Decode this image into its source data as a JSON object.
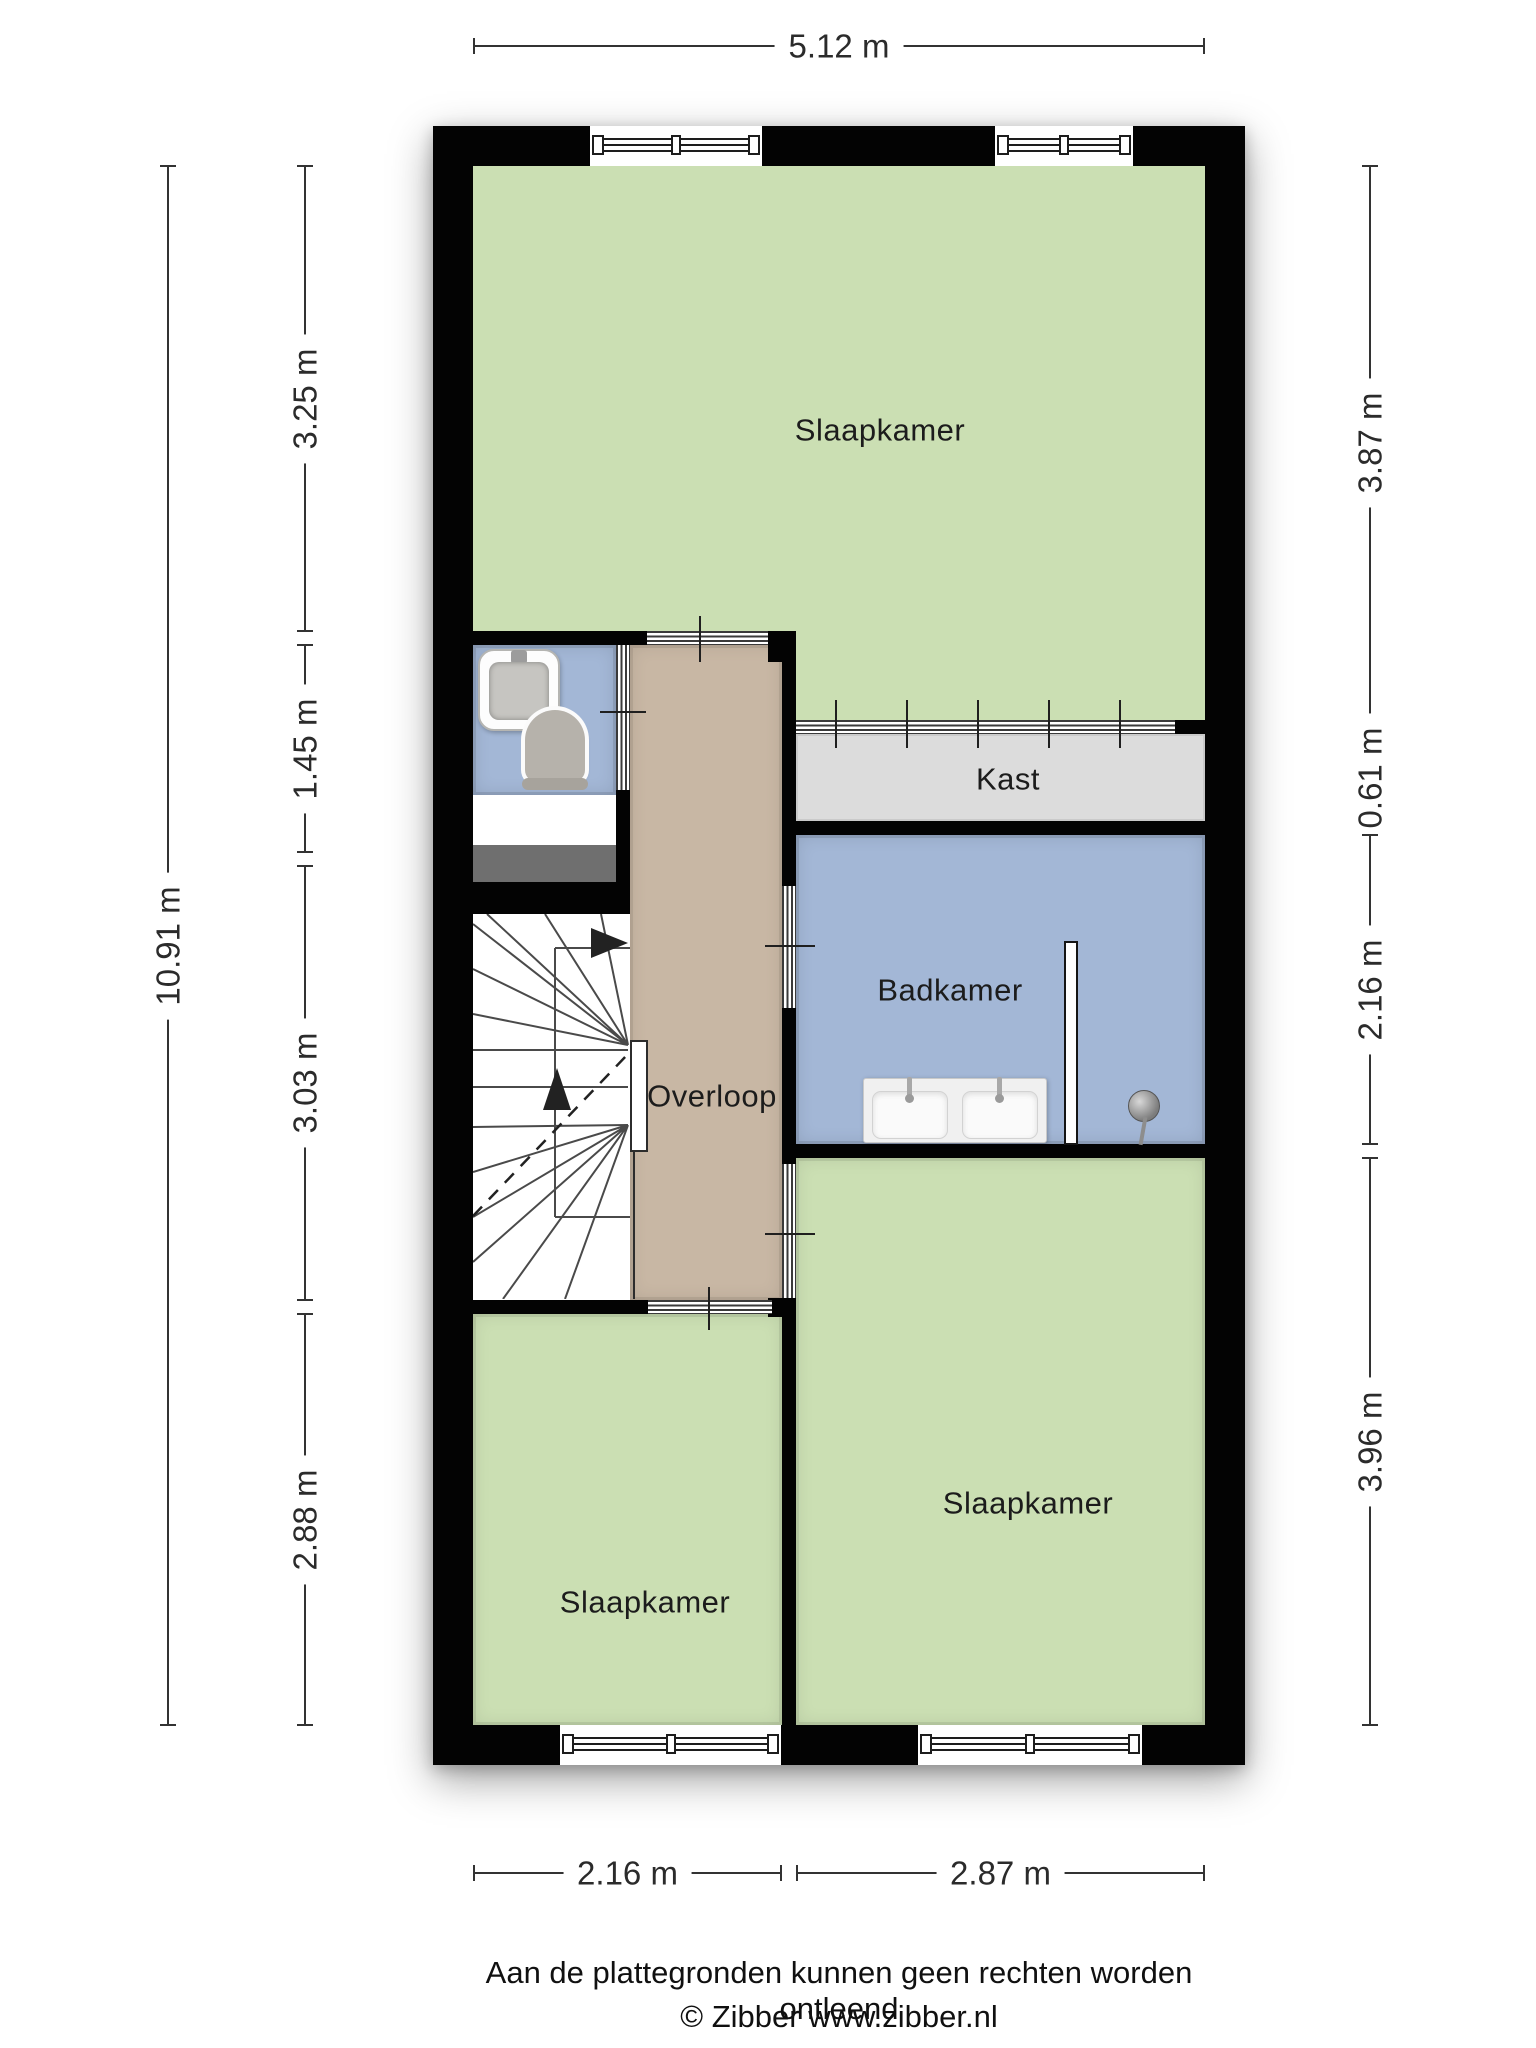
{
  "rooms": {
    "slaapkamer_top": "Slaapkamer",
    "kast": "Kast",
    "badkamer": "Badkamer",
    "overloop": "Overloop",
    "slaapkamer_bottom_left": "Slaapkamer",
    "slaapkamer_bottom_right": "Slaapkamer"
  },
  "dimensions": {
    "top": "5.12 m",
    "left_total": "10.91 m",
    "left": [
      "3.25 m",
      "1.45 m",
      "3.03 m",
      "2.88 m"
    ],
    "right": [
      "3.87 m",
      "0.61 m",
      "2.16 m",
      "3.96 m"
    ],
    "bottom": [
      "2.16 m",
      "2.87 m"
    ]
  },
  "footer": {
    "disclaimer": "Aan de plattegronden kunnen geen rechten worden ontleend",
    "credit": "© Zibber www.zibber.nl"
  },
  "colors": {
    "wall": "#030303",
    "bedroom_fill": "#cbdfb3",
    "bathroom_fill": "#a3b7d6",
    "hallway_fill": "#c8b7a4",
    "closet_fill": "#dcdcdc",
    "stair_strip": "#6f6f6f",
    "dimension_text": "#2b2b2b",
    "label_text": "#1c1c1c"
  }
}
